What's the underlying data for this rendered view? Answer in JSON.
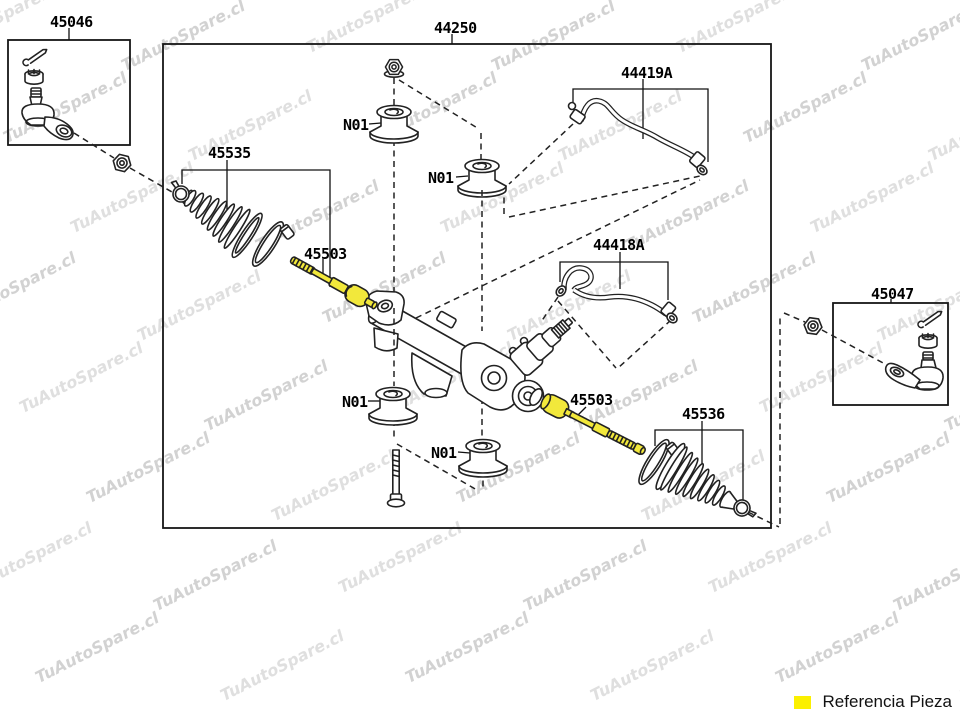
{
  "watermark": {
    "text": "TuAutoSpare.cl"
  },
  "legend": {
    "label": "Referencia Pieza",
    "swatch_color": "#FBF000"
  },
  "colors": {
    "line": "#222222",
    "highlight": "#F2E83B"
  },
  "parts": {
    "assembly": "44250",
    "tie_rod_end_left": "45046",
    "tie_rod_end_right": "45047",
    "boot_left": "45535",
    "boot_right": "45536",
    "rack_end": "45503",
    "pressure_tube_upper": "44419A",
    "pressure_tube_lower": "44418A",
    "grommet": "N01"
  }
}
